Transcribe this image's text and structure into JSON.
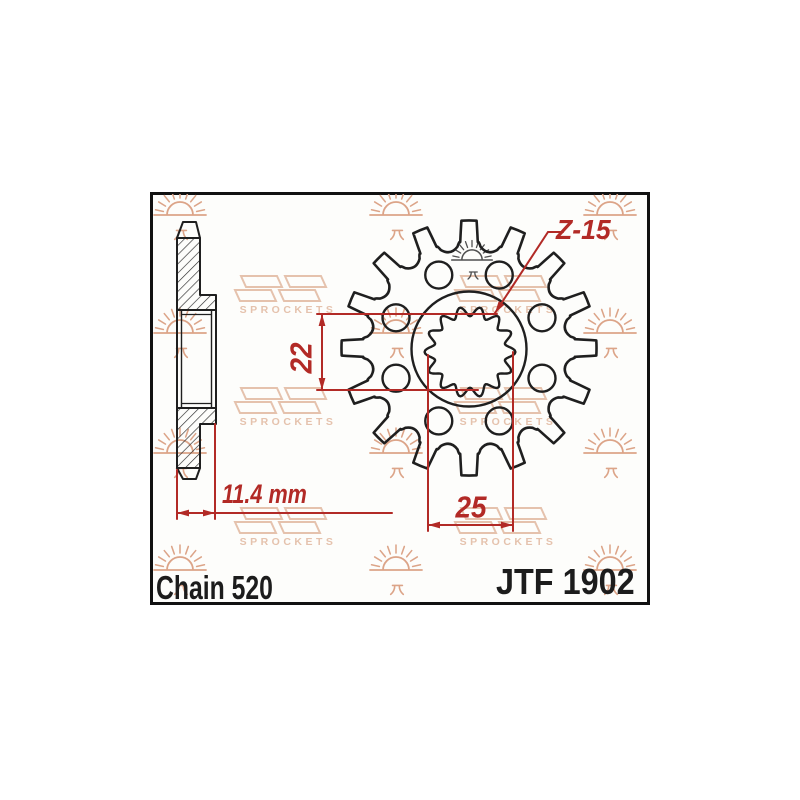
{
  "title_block": {
    "chain": "Chain 520",
    "part_number": "JTF 1902"
  },
  "dimensions": {
    "bore_across_flats": "22",
    "bore_outer_width": "25",
    "hub_thickness": "11.4 mm",
    "teeth_label": "Z-15"
  },
  "watermark": {
    "brand": "SPROCKETS"
  },
  "sprocket": {
    "teeth_drawn": 16,
    "lightening_holes": 8,
    "spline_lobes": 14
  },
  "icons": {
    "sun": "jt-sun-logo",
    "pi_mark": "jt-pi-mark",
    "emblem": "jt-sprockets-emblem"
  },
  "colors": {
    "line": "#1f1f1f",
    "dimension": "#b22a26",
    "watermark_sun": "#dca488",
    "watermark_logo": "#e5c2ad",
    "stamp": "#4f4f4f",
    "paper": "#fdfdfb"
  }
}
